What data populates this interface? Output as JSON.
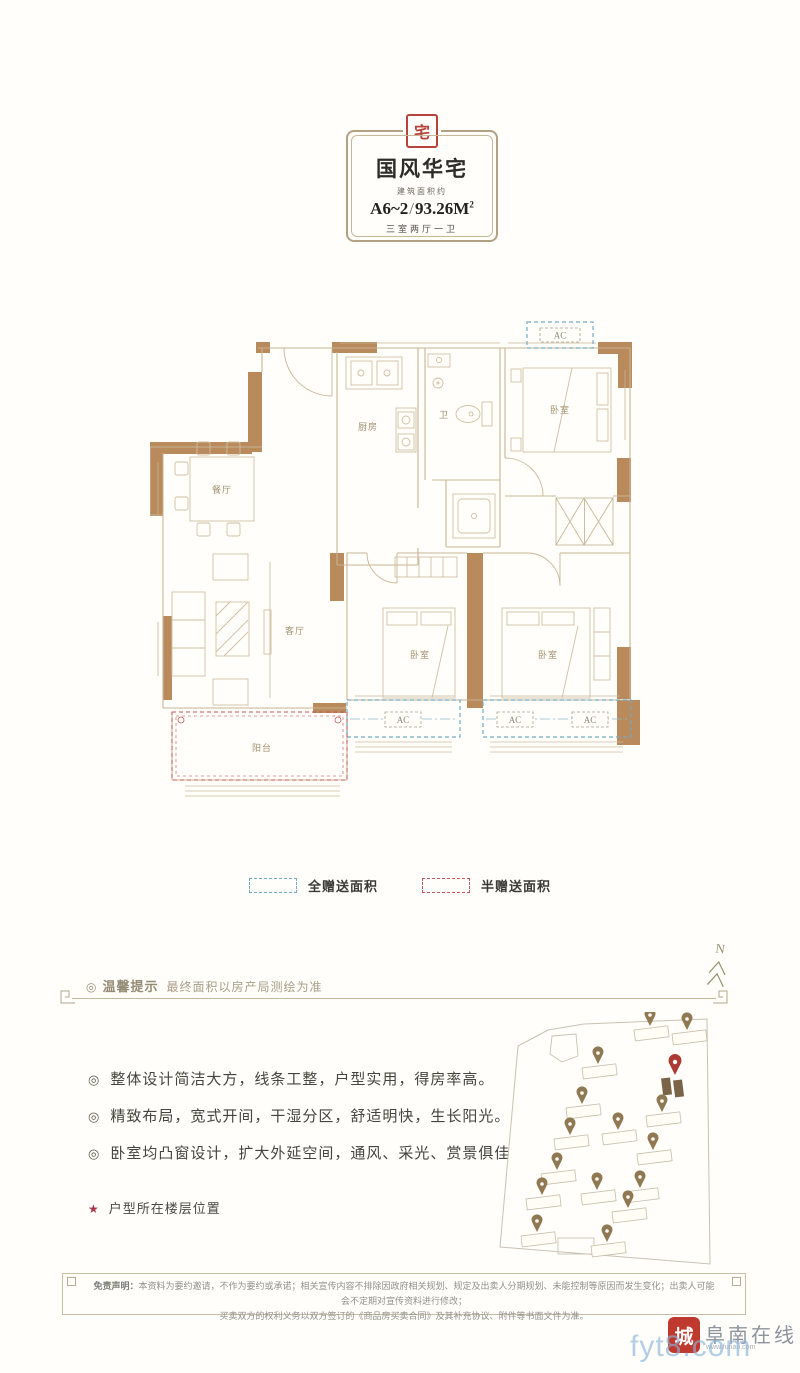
{
  "header": {
    "seal_character": "宅",
    "title": "国风华宅",
    "area_prefix": "建筑面积约",
    "unit_code": "A6~2",
    "slash": "/",
    "area_value": "93.26M",
    "area_sup": "2",
    "rooms_summary": "三室两厅一卫"
  },
  "floorplan": {
    "labels": {
      "kitchen": "厨房",
      "bath": "卫",
      "bedroom_top": "卧室",
      "bedroom_mid": "卧室",
      "bedroom_right": "卧室",
      "dining": "餐厅",
      "living": "客厅",
      "balcony": "阳台",
      "ac": "AC"
    },
    "colors": {
      "wall": "#b98a5c",
      "line": "#c7b494",
      "full_gift": "#72aac4",
      "half_gift": "#c2565a"
    }
  },
  "legend": {
    "full_gift_label": "全赠送面积",
    "half_gift_label": "半赠送面积"
  },
  "notice": {
    "bullet": "◎",
    "title": "温馨提示",
    "text": "最终面积以房产局测绘为准",
    "north_label": "N"
  },
  "features": [
    "整体设计简洁大方，线条工整，户型实用，得房率高。",
    "精致布局，宽式开间，干湿分区，舒适明快，生长阳光。",
    "卧室均凸窗设计，扩大外延空间，通风、采光、赏景俱佳。"
  ],
  "floor_location": {
    "star": "★",
    "label": "户型所在楼层位置"
  },
  "disclaimer": {
    "label": "免责声明：",
    "line1": "本资料为要约邀请，不作为要约或承诺；相关宣传内容不排除因政府相关规划、规定及出卖人分期规划、未能控制等原因而发生变化；出卖人可能会不定期对宣传资料进行修改；",
    "line2": "买卖双方的权利义务以双方签订的《商品房买卖合同》及其补充协议、附件等书面文件为准。"
  },
  "watermark": {
    "seal_text": "城",
    "site_name": "阜南在线",
    "site_url": "www.funan.com",
    "overlay_text": "fyt8.com"
  }
}
